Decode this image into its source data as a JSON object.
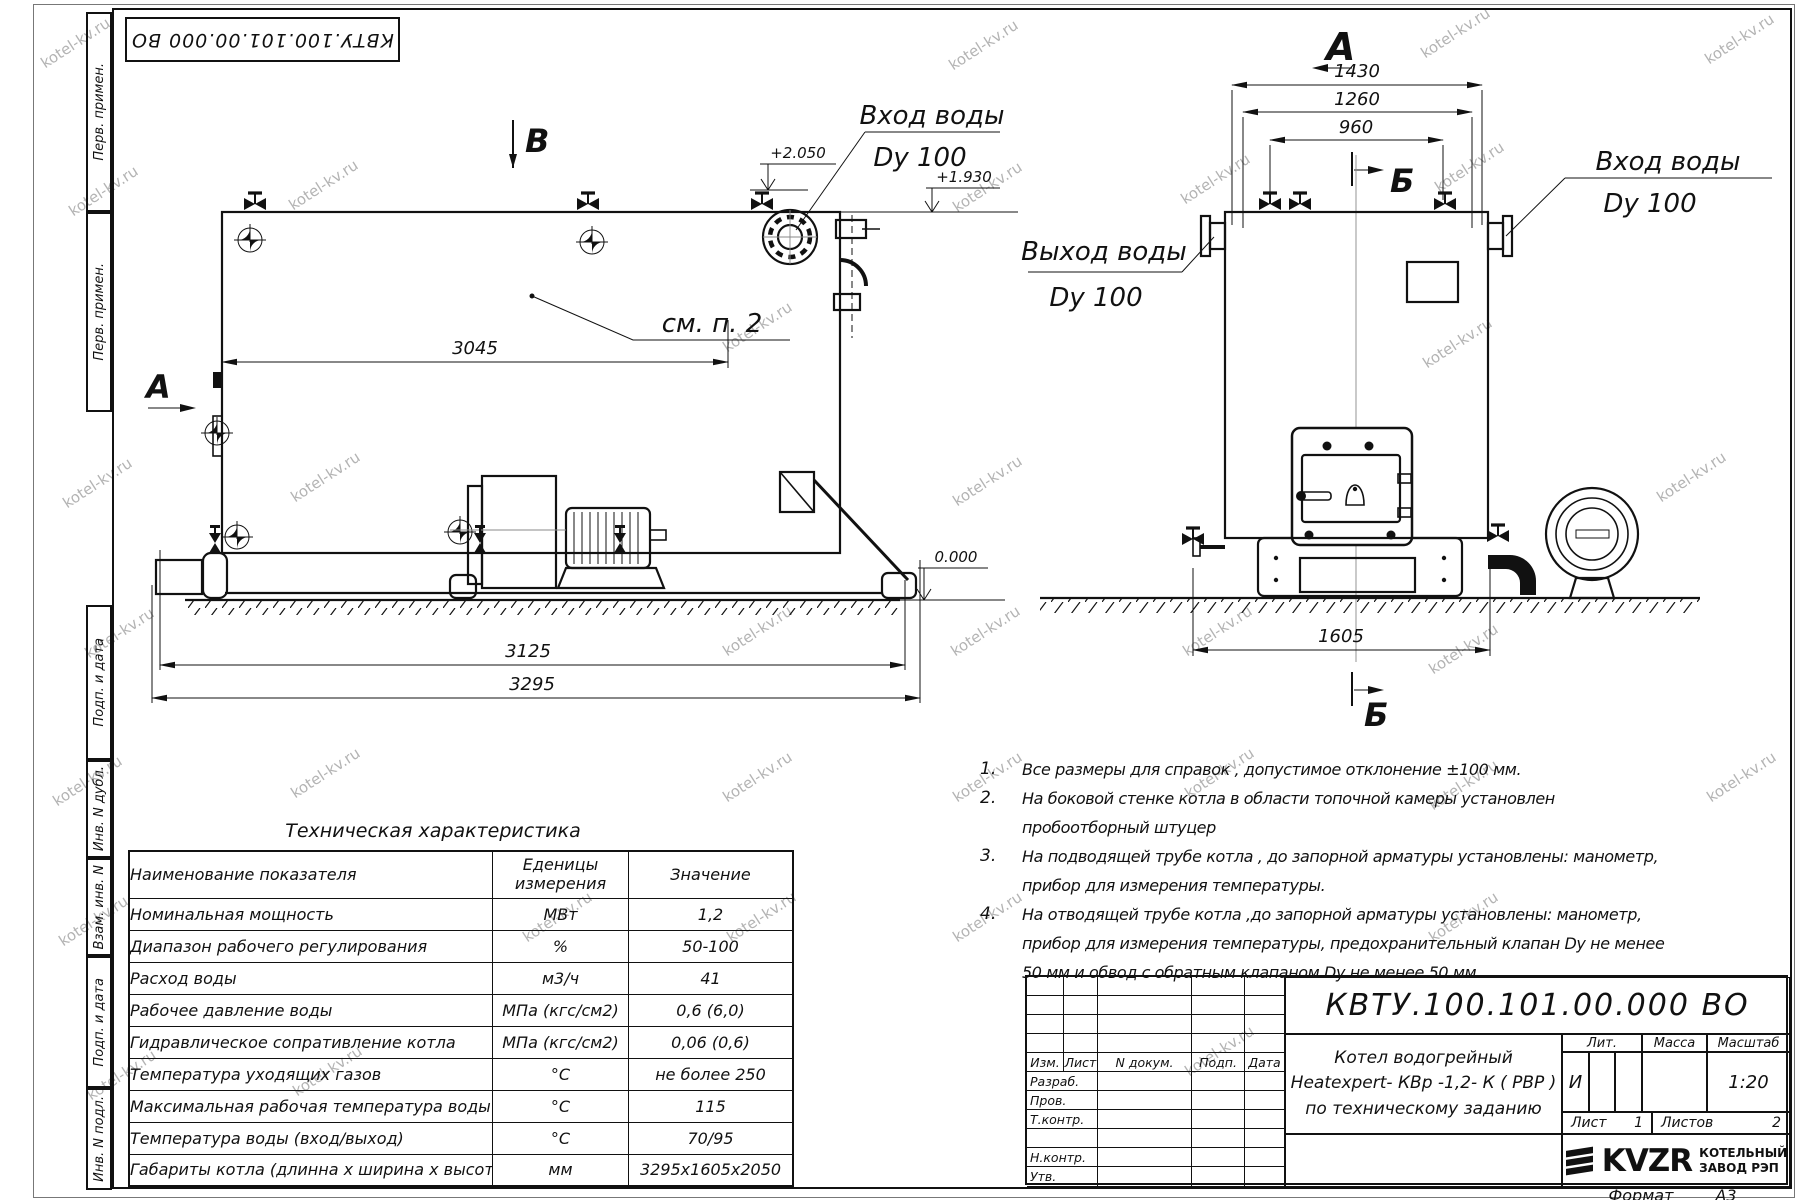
{
  "watermark": "kotel-kv.ru",
  "corner_stamp": "КВТУ.100.101.00.000  ВО",
  "margin_labels": {
    "m1": "Перв. примен.",
    "m2": "Перв. примен.",
    "m3": "Подп. и дата",
    "m4": "Инв. N дубл.",
    "m5": "Взам. инв. N",
    "m6": "Подп. и дата",
    "m7": "Инв. N подл."
  },
  "side_view": {
    "section_b": "В",
    "view_a": "А",
    "see_note": "см. п. 2",
    "inlet_line1": "Вход воды",
    "inlet_line2": "Dy 100",
    "level_2050": "+2.050",
    "level_1930": "+1.930",
    "level_zero": "0.000",
    "dim_3045": "3045",
    "dim_3125": "3125",
    "dim_3295": "3295"
  },
  "front_view": {
    "view_a": "А",
    "section_b_top": "Б",
    "section_b_bottom": "Б",
    "inlet_line1": "Вход воды",
    "inlet_line2": "Dy 100",
    "outlet_line1": "Выход воды",
    "outlet_line2": "Dy 100",
    "dim_1430": "1430",
    "dim_1260": "1260",
    "dim_960": "960",
    "dim_1605": "1605"
  },
  "notes": [
    {
      "n": "1.",
      "t": "Все размеры для справок , допустимое отклонение  ±100 мм."
    },
    {
      "n": "2.",
      "t": "На боковой стенке котла в области топочной камеры установлен пробоотборный штуцер"
    },
    {
      "n": "3.",
      "t": "На  подводящей трубе котла , до запорной арматуры установлены: манометр, прибор для измерения температуры."
    },
    {
      "n": "4.",
      "t": "На отводящей трубе котла ,до запорной арматуры установлены: манометр, прибор для измерения температуры, предохранительный клапан  Dу не менее  50 мм и обвод с обратным клапаном  Dу не менее  50 мм."
    }
  ],
  "spec_table": {
    "title": "Техническая характеристика",
    "col_name": "Наименование показателя",
    "col_units_1": "Еденицы",
    "col_units_2": "измерения",
    "col_value": "Значение",
    "rows": [
      [
        "Номинальная мощность",
        "МВт",
        "1,2"
      ],
      [
        "Диапазон рабочего регулирования",
        "%",
        "50-100"
      ],
      [
        "Расход воды",
        "м3/ч",
        "41"
      ],
      [
        "Рабочее давление воды",
        "МПа (кгс/см2)",
        "0,6 (6,0)"
      ],
      [
        "Гидравлическое сопративление котла",
        "МПа (кгс/см2)",
        "0,06 (0,6)"
      ],
      [
        "Температура уходящих газов",
        "°С",
        "не более 250"
      ],
      [
        "Максимальная рабочая температура воды",
        "°С",
        "115"
      ],
      [
        "Температура воды (вход/выход)",
        "°С",
        "70/95"
      ],
      [
        "Габариты котла (длинна х ширина х высота)",
        "мм",
        "3295х1605х2050"
      ]
    ]
  },
  "title_block": {
    "doc_number": "КВТУ.100.101.00.000  ВО",
    "col_izm": "Изм.",
    "col_list": "Лист",
    "col_ndoc": "N докум.",
    "col_podp": "Подп.",
    "col_data": "Дата",
    "role_1": "Разраб.",
    "role_2": "Пров.",
    "role_3": "Т.контр.",
    "role_4": "Н.контр.",
    "role_5": "Утв.",
    "name_line1": "Котел водогрейный",
    "name_line2": "Heatexpert- КВр -1,2- К ( РВР )",
    "name_line3": "по техническому заданию",
    "lit_label": "Лит.",
    "lit_value": "И",
    "mass_label": "Масса",
    "scale_label": "Масштаб",
    "scale_value": "1:20",
    "sheet_label": "Лист",
    "sheet_value": "1",
    "sheets_label": "Листов",
    "sheets_value": "2",
    "logo_text": "KVZR",
    "logo_line1": "КОТЕЛЬНЫЙ",
    "logo_line2": "ЗАВОД РЭП",
    "format_label": "Формат",
    "format_value": "А3"
  }
}
